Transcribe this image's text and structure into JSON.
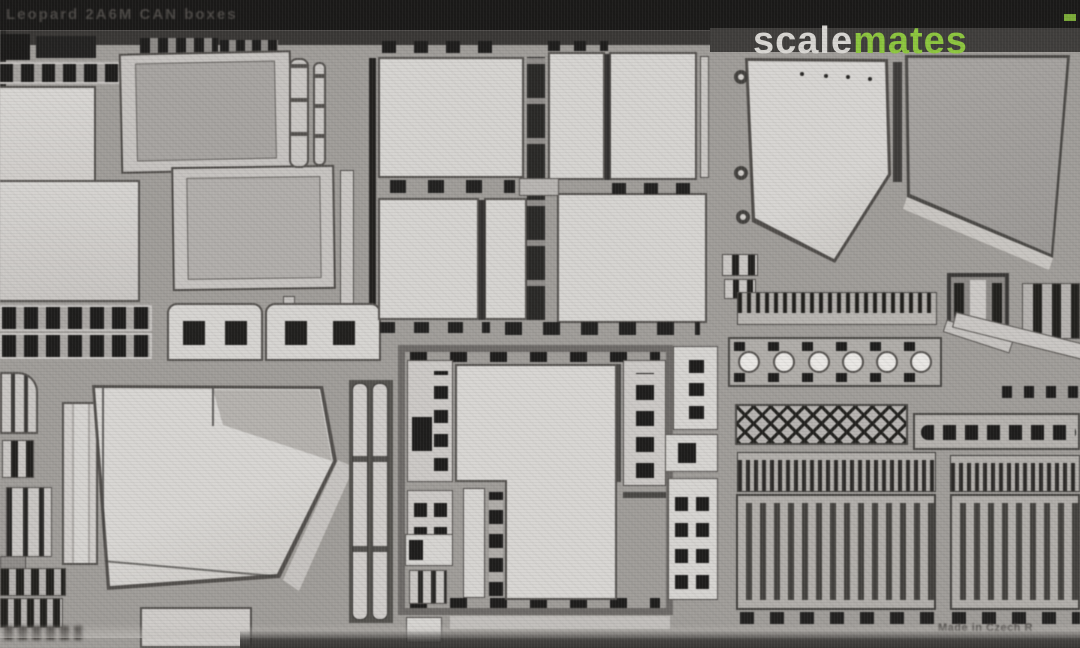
{
  "header": {
    "title": "Leopard 2A6M CAN boxes"
  },
  "watermark": {
    "scale": "scale",
    "mates": "mates"
  },
  "footer": {
    "made_in": "Made in Czech R"
  },
  "colors": {
    "top_bar": "#1b1a19",
    "title_text": "#4c4946",
    "watermark_bg": "#403e3c",
    "watermark_scale": "#d9d7d3",
    "watermark_mates": "#8dc63f",
    "fret_web": "#a09d99",
    "part_light": "#d6d4d1",
    "part_medium": "#b3b0ad",
    "panel_dark": "#a7a4a1",
    "slot_black": "#22211f",
    "edge_dark": "#55524f",
    "footer_text": "#4e4b48",
    "bottom_shadow": "#3a3836"
  }
}
